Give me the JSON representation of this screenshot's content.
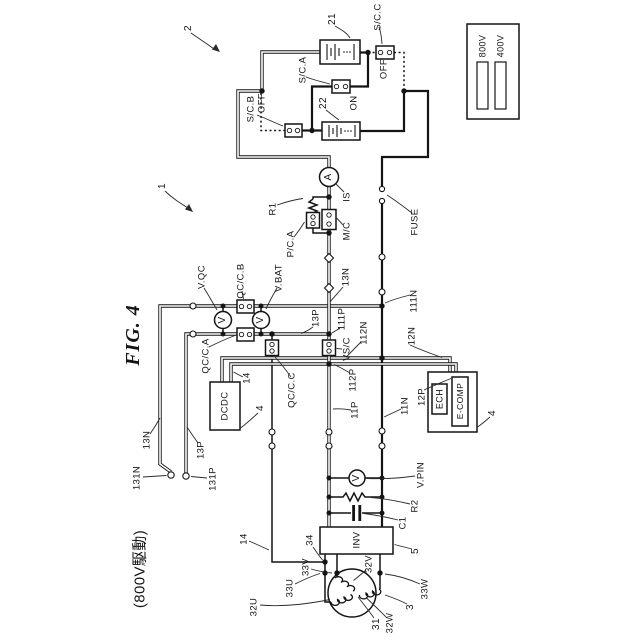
{
  "figure": {
    "kind": "patent-circuit-diagram",
    "orientation": "labels rotated 90deg CCW",
    "canvas": {
      "width": 640,
      "height": 640
    }
  },
  "legend": {
    "items": [
      {
        "label": "800V",
        "bar_color": "#d9d9d9"
      },
      {
        "label": "400V",
        "bar_color": "#949494"
      }
    ]
  },
  "labels": [
    {
      "id": "fig-title",
      "t": "FIG. 4",
      "x": 133,
      "y": 335,
      "s": 20,
      "cls": "title"
    },
    {
      "id": "mode-note",
      "t": "(800V駆動)",
      "x": 140,
      "y": 569,
      "s": 15
    },
    {
      "id": "ref-2",
      "t": "2",
      "x": 189,
      "y": 28,
      "s": 10
    },
    {
      "id": "ref-1",
      "t": "1",
      "x": 163,
      "y": 186,
      "s": 10
    },
    {
      "id": "ref-21",
      "t": "21",
      "x": 333,
      "y": 19,
      "s": 10
    },
    {
      "id": "scc",
      "t": "S/C.C",
      "x": 378,
      "y": 17,
      "s": 9.5
    },
    {
      "id": "scc-state",
      "t": "OFF",
      "x": 384,
      "y": 69,
      "s": 9.5
    },
    {
      "id": "sca",
      "t": "S/C.A",
      "x": 303,
      "y": 70,
      "s": 9.5
    },
    {
      "id": "sca-state",
      "t": "ON",
      "x": 354,
      "y": 103,
      "s": 9.5
    },
    {
      "id": "ref-22",
      "t": "22",
      "x": 324,
      "y": 103,
      "s": 10
    },
    {
      "id": "scb",
      "t": "S/C.B",
      "x": 251,
      "y": 109,
      "s": 9.5
    },
    {
      "id": "scb-state",
      "t": "OFF",
      "x": 262,
      "y": 103,
      "s": 9.5
    },
    {
      "id": "meter-is",
      "t": "A",
      "x": 329,
      "y": 177,
      "s": 10
    },
    {
      "id": "is",
      "t": "IS",
      "x": 347,
      "y": 197,
      "s": 9.5
    },
    {
      "id": "r1",
      "t": "R1",
      "x": 273,
      "y": 209,
      "s": 9.5
    },
    {
      "id": "pca",
      "t": "P/C.A",
      "x": 291,
      "y": 244,
      "s": 9.5
    },
    {
      "id": "mc",
      "t": "M/C",
      "x": 347,
      "y": 231,
      "s": 9.5
    },
    {
      "id": "fuse",
      "t": "FUSE",
      "x": 415,
      "y": 222,
      "s": 9.5
    },
    {
      "id": "l13n",
      "t": "13N",
      "x": 346,
      "y": 277,
      "s": 9.5
    },
    {
      "id": "l111n",
      "t": "111N",
      "x": 414,
      "y": 301,
      "s": 9.5
    },
    {
      "id": "l12n",
      "t": "12N",
      "x": 412,
      "y": 336,
      "s": 9.5
    },
    {
      "id": "l112n",
      "t": "112N",
      "x": 364,
      "y": 333,
      "s": 9.5
    },
    {
      "id": "vqc",
      "t": "V.QC",
      "x": 202,
      "y": 277,
      "s": 9.5
    },
    {
      "id": "meter-vqc",
      "t": "V",
      "x": 223,
      "y": 320,
      "s": 10
    },
    {
      "id": "qccb",
      "t": "QC/C.B",
      "x": 241,
      "y": 281,
      "s": 9.5
    },
    {
      "id": "vbat",
      "t": "V.BAT",
      "x": 279,
      "y": 278,
      "s": 9.5
    },
    {
      "id": "meter-vbat",
      "t": "V",
      "x": 261,
      "y": 320,
      "s": 10
    },
    {
      "id": "qcca",
      "t": "QC/C.A",
      "x": 206,
      "y": 356,
      "s": 9.5
    },
    {
      "id": "qccc",
      "t": "QC/C.C",
      "x": 292,
      "y": 390,
      "s": 9.5
    },
    {
      "id": "l13p",
      "t": "13P",
      "x": 316,
      "y": 318,
      "s": 9.5
    },
    {
      "id": "l111p",
      "t": "111P",
      "x": 342,
      "y": 319,
      "s": 9.5
    },
    {
      "id": "vsc",
      "t": "VS/C",
      "x": 347,
      "y": 349,
      "s": 9.5
    },
    {
      "id": "l112p",
      "t": "112P",
      "x": 353,
      "y": 380,
      "s": 9.5
    },
    {
      "id": "l11p",
      "t": "11P",
      "x": 355,
      "y": 410,
      "s": 9.5
    },
    {
      "id": "l11n",
      "t": "11N",
      "x": 405,
      "y": 406,
      "s": 9.5
    },
    {
      "id": "l12p",
      "t": "12P",
      "x": 422,
      "y": 397,
      "s": 9.5
    },
    {
      "id": "ref-4-ecomp",
      "t": "4",
      "x": 493,
      "y": 413,
      "s": 10
    },
    {
      "id": "ref-4-dcdc",
      "t": "4",
      "x": 261,
      "y": 408,
      "s": 10
    },
    {
      "id": "l14-dcdc",
      "t": "14",
      "x": 247,
      "y": 378,
      "s": 9.5
    },
    {
      "id": "dcdc-text",
      "t": "DCDC",
      "x": 225,
      "y": 406,
      "s": 9.5
    },
    {
      "id": "l13n-left",
      "t": "13N",
      "x": 147,
      "y": 440,
      "s": 9.5
    },
    {
      "id": "l13p-left",
      "t": "13P",
      "x": 201,
      "y": 450,
      "s": 9.5
    },
    {
      "id": "l131n",
      "t": "131N",
      "x": 137,
      "y": 478,
      "s": 9.5
    },
    {
      "id": "l131p",
      "t": "131P",
      "x": 213,
      "y": 479,
      "s": 9.5
    },
    {
      "id": "l14-bottom",
      "t": "14",
      "x": 244,
      "y": 539,
      "s": 9.5
    },
    {
      "id": "ref-34",
      "t": "34",
      "x": 310,
      "y": 540,
      "s": 9.5
    },
    {
      "id": "inv-text",
      "t": "INV",
      "x": 357,
      "y": 540,
      "s": 9.5
    },
    {
      "id": "ref-5",
      "t": "5",
      "x": 416,
      "y": 551,
      "s": 10
    },
    {
      "id": "meter-vpin",
      "t": "V",
      "x": 357,
      "y": 478,
      "s": 10
    },
    {
      "id": "vpin",
      "t": "V.PIN",
      "x": 421,
      "y": 475,
      "s": 9.5
    },
    {
      "id": "r2",
      "t": "R2",
      "x": 415,
      "y": 506,
      "s": 9.5
    },
    {
      "id": "c1",
      "t": "C1",
      "x": 403,
      "y": 523,
      "s": 9.5
    },
    {
      "id": "ech-text",
      "t": "ECH",
      "x": 439.5,
      "y": 399,
      "s": 9
    },
    {
      "id": "ecomp-text",
      "t": "E-COMP",
      "x": 460,
      "y": 401,
      "s": 8.5
    },
    {
      "id": "l33v",
      "t": "33V",
      "x": 306,
      "y": 567,
      "s": 9.5
    },
    {
      "id": "l33u",
      "t": "33U",
      "x": 290,
      "y": 588,
      "s": 9.5
    },
    {
      "id": "l32v",
      "t": "32V",
      "x": 369,
      "y": 564,
      "s": 9.5
    },
    {
      "id": "l32u",
      "t": "32U",
      "x": 254,
      "y": 607,
      "s": 9.5
    },
    {
      "id": "l33w",
      "t": "33W",
      "x": 425,
      "y": 589,
      "s": 9.5
    },
    {
      "id": "l32w",
      "t": "32W",
      "x": 390,
      "y": 623,
      "s": 9.5
    },
    {
      "id": "ref-31",
      "t": "31",
      "x": 377,
      "y": 624,
      "s": 10
    },
    {
      "id": "ref-3",
      "t": "3",
      "x": 411,
      "y": 607,
      "s": 10
    },
    {
      "id": "leg-800",
      "t": "800V",
      "x": 483,
      "y": 46,
      "s": 9
    },
    {
      "id": "leg-400",
      "t": "400V",
      "x": 501,
      "y": 46,
      "s": 9
    }
  ]
}
